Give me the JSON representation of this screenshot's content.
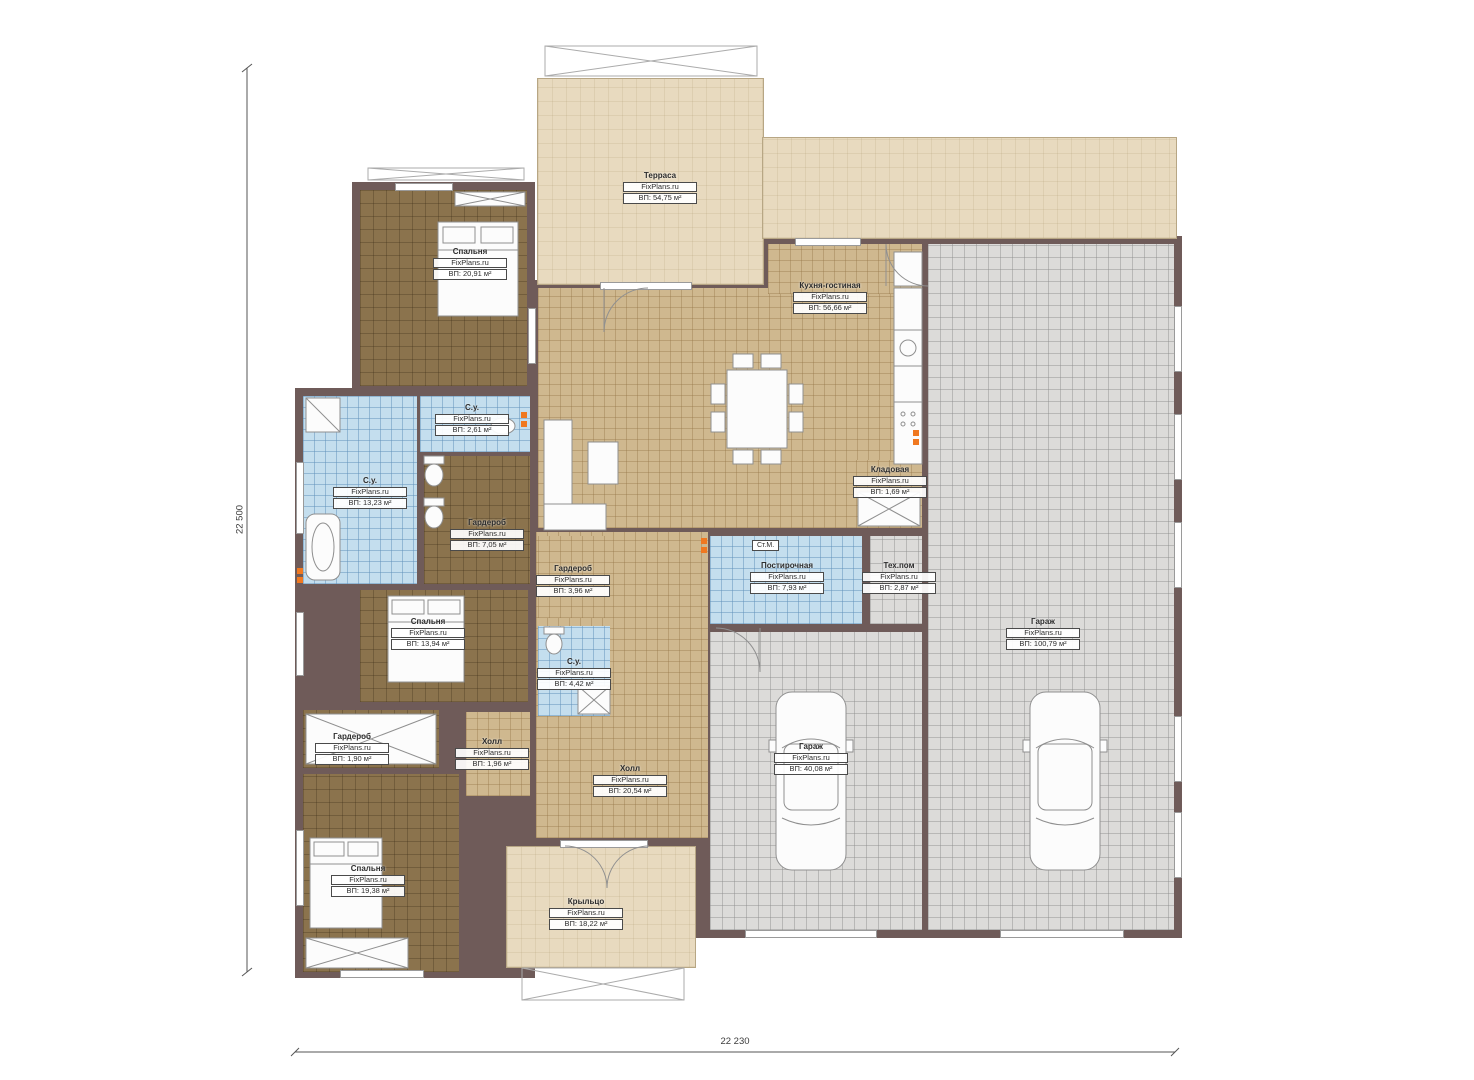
{
  "branding": {
    "watermark": "FixPlans.ru"
  },
  "plan": {
    "type": "floor-plan",
    "dimensions": {
      "left_total": "22 500",
      "bottom_total": "22 230"
    },
    "appliance_labels": {
      "washer": "Ст.М."
    }
  },
  "rooms": [
    {
      "name": "Терраса",
      "area": "ВП: 54,75 м²"
    },
    {
      "name": "Спальня",
      "area": "ВП: 20,91 м²"
    },
    {
      "name": "Кухня-гостиная",
      "area": "ВП: 56,66 м²"
    },
    {
      "name": "С.у.",
      "area": "ВП: 2,61 м²"
    },
    {
      "name": "С.у.",
      "area": "ВП: 13,23 м²"
    },
    {
      "name": "Гардероб",
      "area": "ВП: 7,05 м²"
    },
    {
      "name": "Кладовая",
      "area": "ВП: 1,69 м²"
    },
    {
      "name": "Гардероб",
      "area": "ВП: 3,96 м²"
    },
    {
      "name": "Постирочная",
      "area": "ВП: 7,93 м²"
    },
    {
      "name": "Тех.пом",
      "area": "ВП: 2,87 м²"
    },
    {
      "name": "Гараж",
      "area": "ВП: 100,79 м²"
    },
    {
      "name": "Спальня",
      "area": "ВП: 13,94 м²"
    },
    {
      "name": "С.у.",
      "area": "ВП: 4,42 м²"
    },
    {
      "name": "Гардероб",
      "area": "ВП: 1,90 м²"
    },
    {
      "name": "Холл",
      "area": "ВП: 1,96 м²"
    },
    {
      "name": "Холл",
      "area": "ВП: 20,54 м²"
    },
    {
      "name": "Гараж",
      "area": "ВП: 40,08 м²"
    },
    {
      "name": "Спальня",
      "area": "ВП: 19,38 м²"
    },
    {
      "name": "Крыльцо",
      "area": "ВП: 18,22 м²"
    }
  ],
  "colors": {
    "wall": "#6f5b59",
    "floor_wood": "#8b734d",
    "floor_tile_tan": "#cfb88f",
    "floor_tile_blue": "#c4deee",
    "floor_garage": "#dcdbd9",
    "terrace": "#e8dabf",
    "radiator": "#f07820"
  }
}
